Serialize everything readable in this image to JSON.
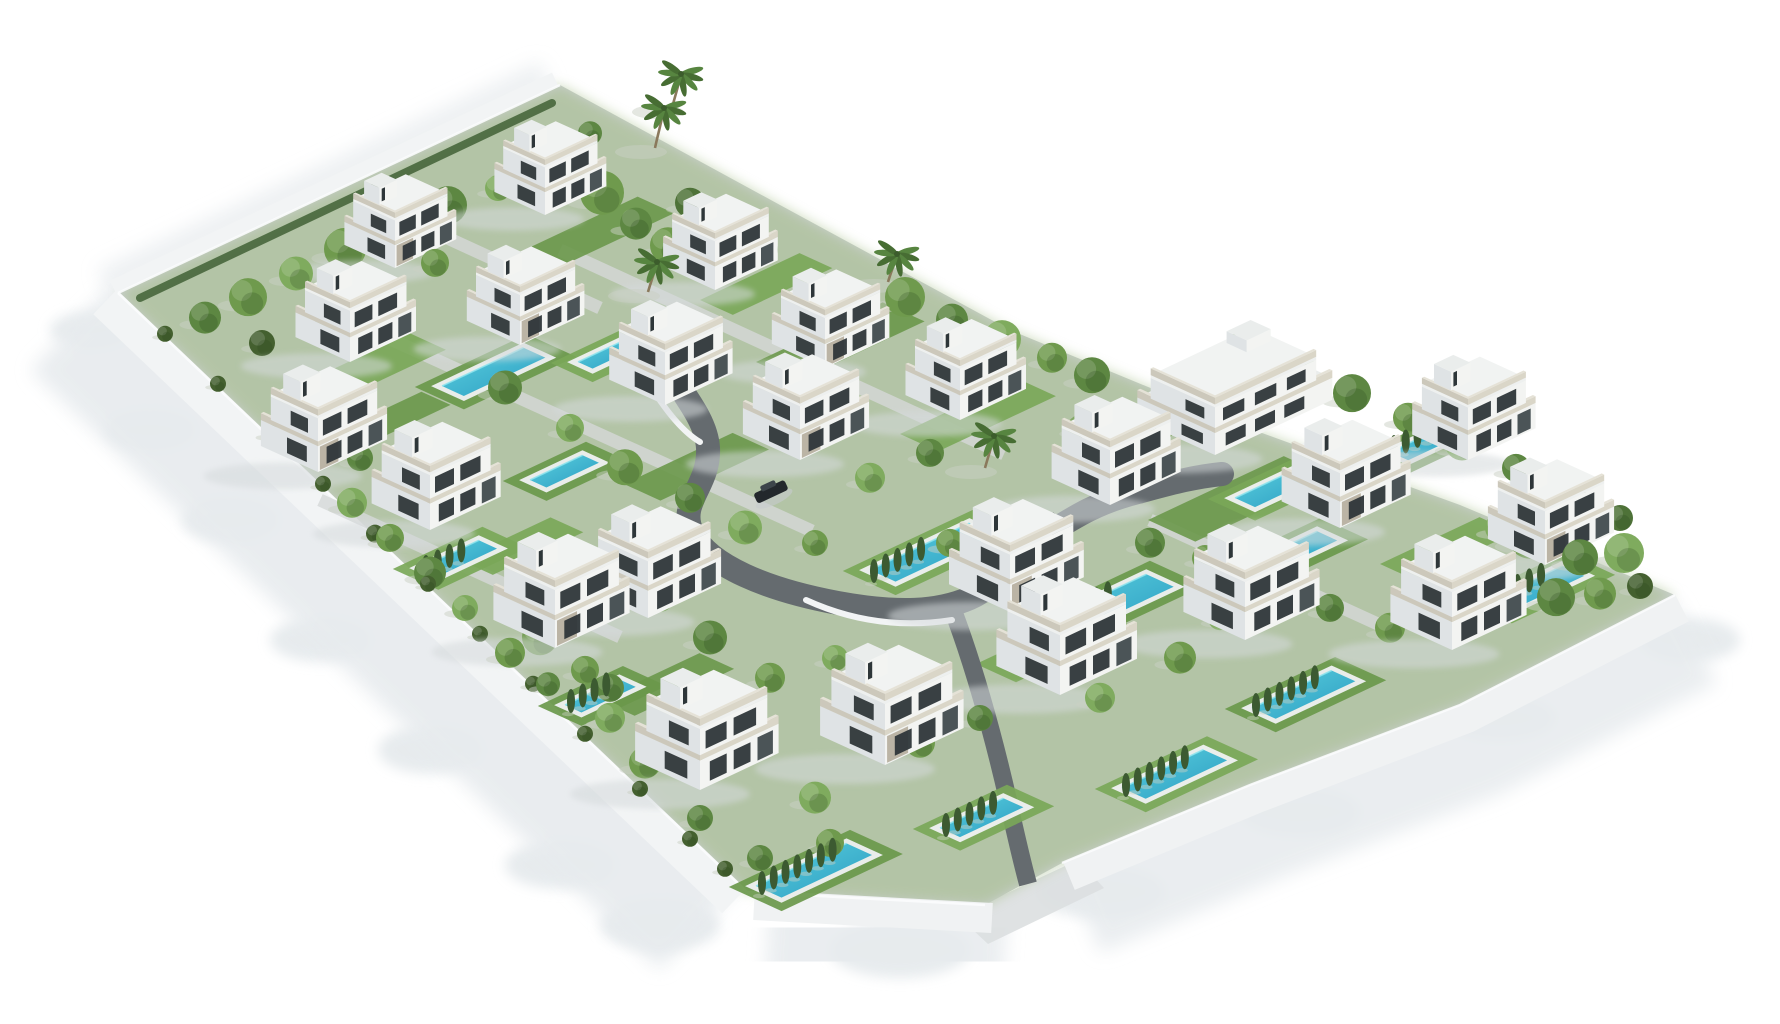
{
  "scene": {
    "width": 1780,
    "height": 1024,
    "colors": {
      "bg": "#ffffff",
      "base": "#ccd1d1",
      "wash": "#9cb87c",
      "wallFill": "#f2f4f5",
      "wallFill2": "#f0f2f3",
      "coping": "#fbfcfd",
      "shadow1": "#e7ebee",
      "shadow2": "#e3e8eb",
      "apron": "#dcdfe0",
      "road": "#656b6f",
      "arc": "#f2f4f5",
      "strip": "#d6d9d9",
      "hedgeNW": "#47663c"
    },
    "villaColors": {
      "faceL": "#dfe3e5",
      "faceR": "#f3f4f2",
      "faceT": "#eaedec",
      "slab": "#eef0ef",
      "slabT": "#f1f3f2",
      "rail": "#dad6c8",
      "railL": "#ccc8bb",
      "railT": "#e5e2d7",
      "win": "#2e3639",
      "winL": "#272d30",
      "door": "#394246",
      "stone": "#8d8066",
      "shadow": "#d5dadc"
    },
    "poolColors": {
      "deck": "#eef0f0",
      "w1": "#5bd0de",
      "w2": "#2b9cc2",
      "hl": "#8ee4ee",
      "lawnA": "#79a758",
      "lawnB": "#6a984b"
    },
    "treeColors": {
      "palette": [
        "#6f9a4d",
        "#5d8742",
        "#7fab5e",
        "#4e7238",
        "#86b065",
        "#44602f"
      ],
      "cypress": "#3c5a31",
      "trunk": "#8a795c",
      "palm1": "#476d33",
      "palm2": "#578540",
      "shadow": "#c9d0c4"
    },
    "carColors": {
      "body": "#23282c",
      "top": "#3d454a",
      "shadow": "#c6cbce"
    },
    "outline": [
      [
        560,
        85
      ],
      [
        780,
        205
      ],
      [
        1010,
        330
      ],
      [
        1240,
        425
      ],
      [
        1460,
        505
      ],
      [
        1675,
        595
      ],
      [
        1460,
        705
      ],
      [
        1250,
        785
      ],
      [
        1062,
        863
      ],
      [
        985,
        905
      ],
      [
        747,
        892
      ],
      [
        118,
        293
      ]
    ],
    "wallLeft": "M118,293 L747,892",
    "wallBottom1": "M747,892 L985,905",
    "wallBottom2": "M1062,863 L1250,785 L1460,705 L1675,595",
    "wallNW": "M118,293 L560,85",
    "hedgeNWPath": "M140,298 L552,103",
    "apronQuad": [
      [
        958,
        916
      ],
      [
        1078,
        860
      ],
      [
        1104,
        888
      ],
      [
        988,
        944
      ]
    ],
    "shadowLumps": [
      [
        150,
        430,
        45,
        20
      ],
      [
        230,
        520,
        48,
        22
      ],
      [
        320,
        640,
        50,
        22
      ],
      [
        430,
        750,
        52,
        24
      ],
      [
        560,
        865,
        55,
        24
      ],
      [
        660,
        925,
        60,
        26
      ],
      [
        900,
        950,
        70,
        28
      ],
      [
        1100,
        892,
        65,
        26
      ],
      [
        1300,
        812,
        60,
        24
      ],
      [
        1500,
        718,
        55,
        22
      ],
      [
        1690,
        640,
        50,
        22
      ],
      [
        90,
        330,
        40,
        18
      ]
    ],
    "road": {
      "main": "M650,336 C668,380 706,412 708,448 C710,486 678,502 692,532 C708,566 768,590 838,603 C898,614 938,612 970,598 C1002,584 1012,556 1044,536 C1076,516 1098,502 1138,492 C1168,484 1192,477 1222,474",
      "spur": "M952,608 C972,660 992,730 1008,800 C1016,836 1022,862 1028,884",
      "arcs": [
        "M648,382 Q676,428 700,442",
        "M806,600 Q876,632 952,620",
        "M1040,548 Q1014,570 990,596"
      ]
    },
    "strips": [
      [
        560,
        250,
        1004,
        454
      ],
      [
        388,
        338,
        812,
        531
      ],
      [
        320,
        500,
        620,
        637
      ],
      [
        1150,
        520,
        1380,
        625
      ],
      [
        430,
        230,
        600,
        308
      ]
    ],
    "lawns": [
      [
        310,
        380,
        110,
        40
      ],
      [
        520,
        252,
        130,
        40
      ],
      [
        700,
        300,
        110,
        36
      ],
      [
        756,
        362,
        140,
        46
      ],
      [
        460,
        560,
        100,
        36
      ],
      [
        624,
        484,
        120,
        40
      ],
      [
        900,
        434,
        130,
        42
      ],
      [
        1148,
        520,
        150,
        52
      ],
      [
        976,
        664,
        130,
        44
      ],
      [
        600,
        700,
        110,
        38
      ],
      [
        1380,
        564,
        110,
        38
      ],
      [
        340,
        430,
        90,
        32
      ]
    ],
    "pools": [
      [
        442,
        386,
        90,
        24
      ],
      [
        578,
        362,
        55,
        16
      ],
      [
        530,
        480,
        58,
        18
      ],
      [
        420,
        568,
        65,
        20
      ],
      [
        565,
        705,
        60,
        18
      ],
      [
        870,
        570,
        110,
        28
      ],
      [
        1045,
        622,
        112,
        30
      ],
      [
        1235,
        498,
        70,
        22
      ],
      [
        1252,
        562,
        72,
        22
      ],
      [
        940,
        828,
        70,
        22
      ],
      [
        756,
        886,
        100,
        28
      ],
      [
        1122,
        788,
        90,
        26
      ],
      [
        1252,
        708,
        88,
        26
      ],
      [
        1490,
        600,
        80,
        24
      ],
      [
        1390,
        452,
        62,
        20
      ]
    ],
    "villas": [
      [
        545,
        215,
        0.78,
        0
      ],
      [
        395,
        268,
        0.78,
        1
      ],
      [
        715,
        290,
        0.8,
        0
      ],
      [
        825,
        368,
        0.82,
        1
      ],
      [
        960,
        420,
        0.84,
        0
      ],
      [
        350,
        362,
        0.84,
        0
      ],
      [
        520,
        345,
        0.82,
        1
      ],
      [
        665,
        405,
        0.86,
        0
      ],
      [
        800,
        460,
        0.88,
        1
      ],
      [
        318,
        472,
        0.88,
        1
      ],
      [
        430,
        530,
        0.9,
        0
      ],
      [
        648,
        618,
        0.93,
        0
      ],
      [
        1110,
        505,
        0.9,
        0
      ],
      [
        1010,
        612,
        0.94,
        1
      ],
      [
        555,
        648,
        0.95,
        1
      ],
      [
        700,
        790,
        1.0,
        0
      ],
      [
        885,
        765,
        1.0,
        1
      ],
      [
        1060,
        695,
        0.98,
        0
      ],
      [
        1245,
        640,
        0.95,
        0
      ],
      [
        1340,
        528,
        0.9,
        1
      ],
      [
        1468,
        460,
        0.86,
        0
      ],
      [
        1545,
        565,
        0.88,
        1
      ],
      [
        1452,
        650,
        0.95,
        0
      ],
      [
        1215,
        455,
        0.95,
        2
      ]
    ],
    "trees": [
      [
        205,
        320,
        16,
        1
      ],
      [
        248,
        300,
        19,
        0
      ],
      [
        296,
        276,
        17,
        2
      ],
      [
        345,
        252,
        21,
        0
      ],
      [
        398,
        232,
        15,
        3
      ],
      [
        448,
        208,
        19,
        1
      ],
      [
        498,
        190,
        13,
        2
      ],
      [
        262,
        345,
        13,
        5
      ],
      [
        330,
        318,
        16,
        1
      ],
      [
        435,
        265,
        14,
        0
      ],
      [
        568,
        170,
        18,
        2
      ],
      [
        602,
        196,
        22,
        0
      ],
      [
        636,
        226,
        16,
        1
      ],
      [
        690,
        205,
        15,
        3
      ],
      [
        590,
        135,
        12,
        1
      ],
      [
        668,
        248,
        18,
        0
      ],
      [
        730,
        225,
        13,
        2
      ],
      [
        762,
        252,
        16,
        1
      ],
      [
        905,
        300,
        20,
        0
      ],
      [
        952,
        322,
        16,
        1
      ],
      [
        1002,
        342,
        19,
        2
      ],
      [
        1052,
        360,
        15,
        0
      ],
      [
        1092,
        378,
        18,
        1
      ],
      [
        1246,
        352,
        20,
        0
      ],
      [
        1300,
        372,
        16,
        2
      ],
      [
        1352,
        396,
        19,
        1
      ],
      [
        1408,
        420,
        15,
        0
      ],
      [
        1462,
        446,
        17,
        2
      ],
      [
        1516,
        470,
        14,
        1
      ],
      [
        1570,
        494,
        16,
        0
      ],
      [
        1620,
        520,
        13,
        3
      ],
      [
        1530,
        540,
        22,
        0
      ],
      [
        1580,
        560,
        18,
        1
      ],
      [
        1624,
        556,
        20,
        2
      ],
      [
        1600,
        596,
        16,
        0
      ],
      [
        1556,
        600,
        19,
        1
      ],
      [
        1640,
        588,
        13,
        5
      ],
      [
        1500,
        530,
        15,
        2
      ],
      [
        560,
        300,
        15,
        0
      ],
      [
        505,
        390,
        17,
        1
      ],
      [
        570,
        430,
        14,
        2
      ],
      [
        625,
        470,
        18,
        0
      ],
      [
        690,
        500,
        15,
        1
      ],
      [
        745,
        530,
        17,
        2
      ],
      [
        815,
        545,
        13,
        0
      ],
      [
        600,
        590,
        16,
        1
      ],
      [
        540,
        640,
        18,
        0
      ],
      [
        660,
        600,
        14,
        2
      ],
      [
        710,
        640,
        17,
        1
      ],
      [
        770,
        680,
        15,
        0
      ],
      [
        835,
        660,
        13,
        2
      ],
      [
        905,
        680,
        16,
        1
      ],
      [
        950,
        545,
        14,
        0
      ],
      [
        870,
        480,
        15,
        2
      ],
      [
        930,
        455,
        14,
        1
      ],
      [
        1080,
        430,
        13,
        0
      ],
      [
        320,
        430,
        16,
        0
      ],
      [
        360,
        460,
        13,
        1
      ],
      [
        352,
        505,
        15,
        2
      ],
      [
        390,
        540,
        14,
        0
      ],
      [
        430,
        575,
        16,
        1
      ],
      [
        465,
        610,
        13,
        2
      ],
      [
        510,
        655,
        15,
        0
      ],
      [
        610,
        690,
        14,
        1
      ],
      [
        585,
        672,
        14,
        0
      ],
      [
        548,
        686,
        12,
        1
      ],
      [
        610,
        720,
        15,
        2
      ],
      [
        645,
        765,
        16,
        0
      ],
      [
        700,
        820,
        13,
        1
      ],
      [
        815,
        800,
        16,
        2
      ],
      [
        920,
        745,
        15,
        0
      ],
      [
        980,
        720,
        13,
        1
      ],
      [
        1100,
        700,
        15,
        2
      ],
      [
        1180,
        660,
        16,
        0
      ],
      [
        760,
        860,
        13,
        1
      ],
      [
        830,
        845,
        14,
        0
      ],
      [
        1150,
        545,
        15,
        1
      ],
      [
        1205,
        560,
        13,
        0
      ],
      [
        1270,
        590,
        16,
        2
      ],
      [
        1330,
        610,
        14,
        1
      ],
      [
        1390,
        630,
        15,
        0
      ],
      [
        1220,
        620,
        12,
        2
      ],
      [
        1430,
        600,
        13,
        1
      ],
      [
        1160,
        430,
        14,
        0
      ],
      [
        165,
        335,
        8,
        5
      ],
      [
        218,
        385,
        8,
        5
      ],
      [
        270,
        435,
        9,
        5
      ],
      [
        323,
        485,
        8,
        5
      ],
      [
        375,
        535,
        9,
        5
      ],
      [
        428,
        585,
        8,
        5
      ],
      [
        480,
        635,
        8,
        5
      ],
      [
        533,
        685,
        8,
        5
      ],
      [
        585,
        735,
        8,
        5
      ],
      [
        640,
        790,
        8,
        5
      ],
      [
        690,
        840,
        8,
        5
      ],
      [
        725,
        870,
        8,
        5
      ]
    ],
    "palms": [
      [
        655,
        148,
        40
      ],
      [
        672,
        108,
        34
      ],
      [
        648,
        292,
        30
      ],
      [
        888,
        282,
        28
      ],
      [
        985,
        468,
        32
      ],
      [
        872,
        732,
        28
      ]
    ],
    "cypressRows": [
      [
        762,
        894,
        7
      ],
      [
        946,
        836,
        5
      ],
      [
        1126,
        796,
        6
      ],
      [
        1256,
        716,
        6
      ],
      [
        1494,
        608,
        5
      ],
      [
        1049,
        632,
        6
      ],
      [
        426,
        578,
        4
      ],
      [
        571,
        712,
        4
      ],
      [
        874,
        582,
        5
      ],
      [
        1394,
        458,
        4
      ]
    ],
    "cars": [
      [
        772,
        494
      ],
      [
        1042,
        526
      ]
    ]
  }
}
